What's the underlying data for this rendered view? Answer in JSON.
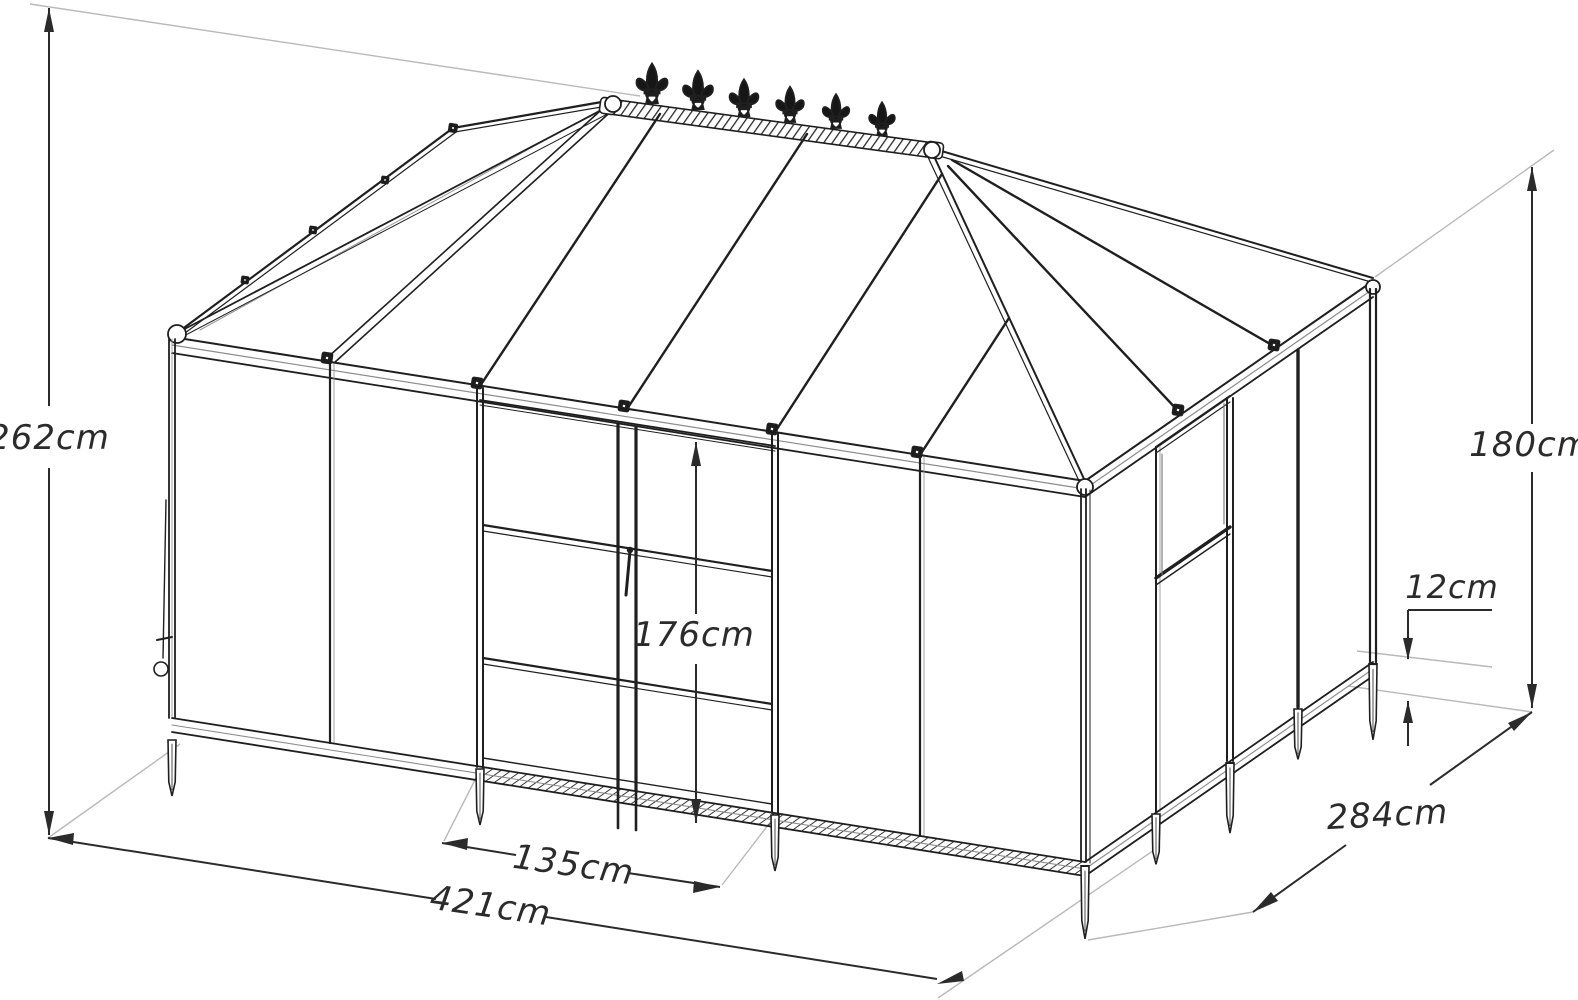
{
  "title": "Greenhouse orangery technical line drawing with dimensions",
  "units": "cm",
  "dimensions": {
    "total_height": {
      "label": "262cm"
    },
    "eave_wall_height": {
      "label": "180cm"
    },
    "base_plinth_height": {
      "label": "12cm"
    },
    "door_height": {
      "label": "176cm"
    },
    "door_width": {
      "label": "135cm"
    },
    "front_width": {
      "label": "421cm"
    },
    "side_depth": {
      "label": "284cm"
    }
  },
  "structure": {
    "finial_count": 6,
    "features": [
      "hipped glass roof",
      "ridge cresting with fleur-de-lis finials",
      "double front doors with handle",
      "side vent window",
      "ground anchor stakes"
    ]
  },
  "colors": {
    "line": "#1f1f1f",
    "dimension": "#2b2b2b",
    "extension": "#b9b9b9",
    "background": "#ffffff"
  }
}
